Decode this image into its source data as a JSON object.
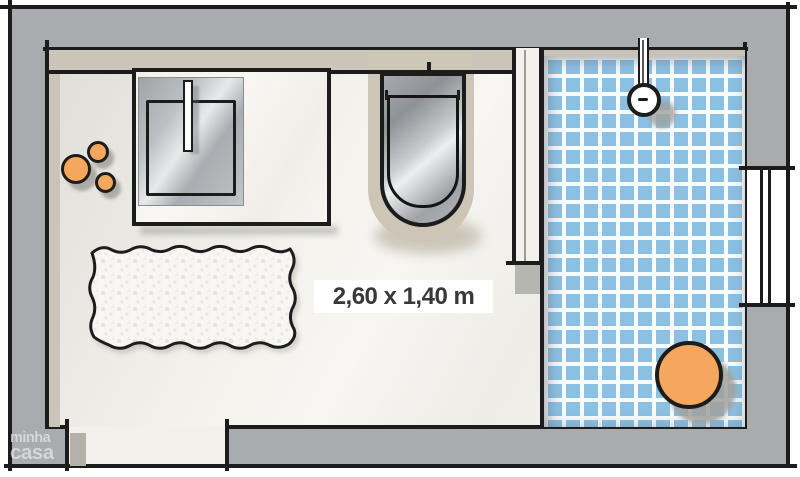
{
  "plan": {
    "type": "bathroom-floor-plan",
    "fixtures": [
      "washbasin-counter",
      "sink",
      "faucet",
      "toiletries",
      "toilet",
      "partition-wall",
      "shower-tiled-area",
      "shower-head",
      "shower-stool",
      "bath-rug",
      "door-opening",
      "window"
    ]
  },
  "label": {
    "dimensions": "2,60 x 1,40 m"
  },
  "brand": {
    "line1": "minha",
    "line2": "casa"
  },
  "colors": {
    "wall": "#A9ABAF",
    "outline": "#1C1C1C",
    "floor_a": "#DFDDD6",
    "floor_b": "#F7F6F2",
    "floor_door": "#F1F0EB",
    "beige": "#CBC5B9",
    "alcove": "#CDC5B5",
    "tile_blue": "#8CC0E2",
    "grout": "#F7FBFD",
    "orange": "#F5A75E",
    "shadow_gray": "#A1A19C",
    "metal_a": "#9FA3A7",
    "metal_b": "#E8E9EA",
    "metal_c": "#A9ACB0",
    "counter": "#F8F7F3",
    "partition_fill": "#F2F1ED",
    "post_gray": "#B6B6B1",
    "label_bg": "#FFFFFF",
    "label_text": "#38383A"
  }
}
